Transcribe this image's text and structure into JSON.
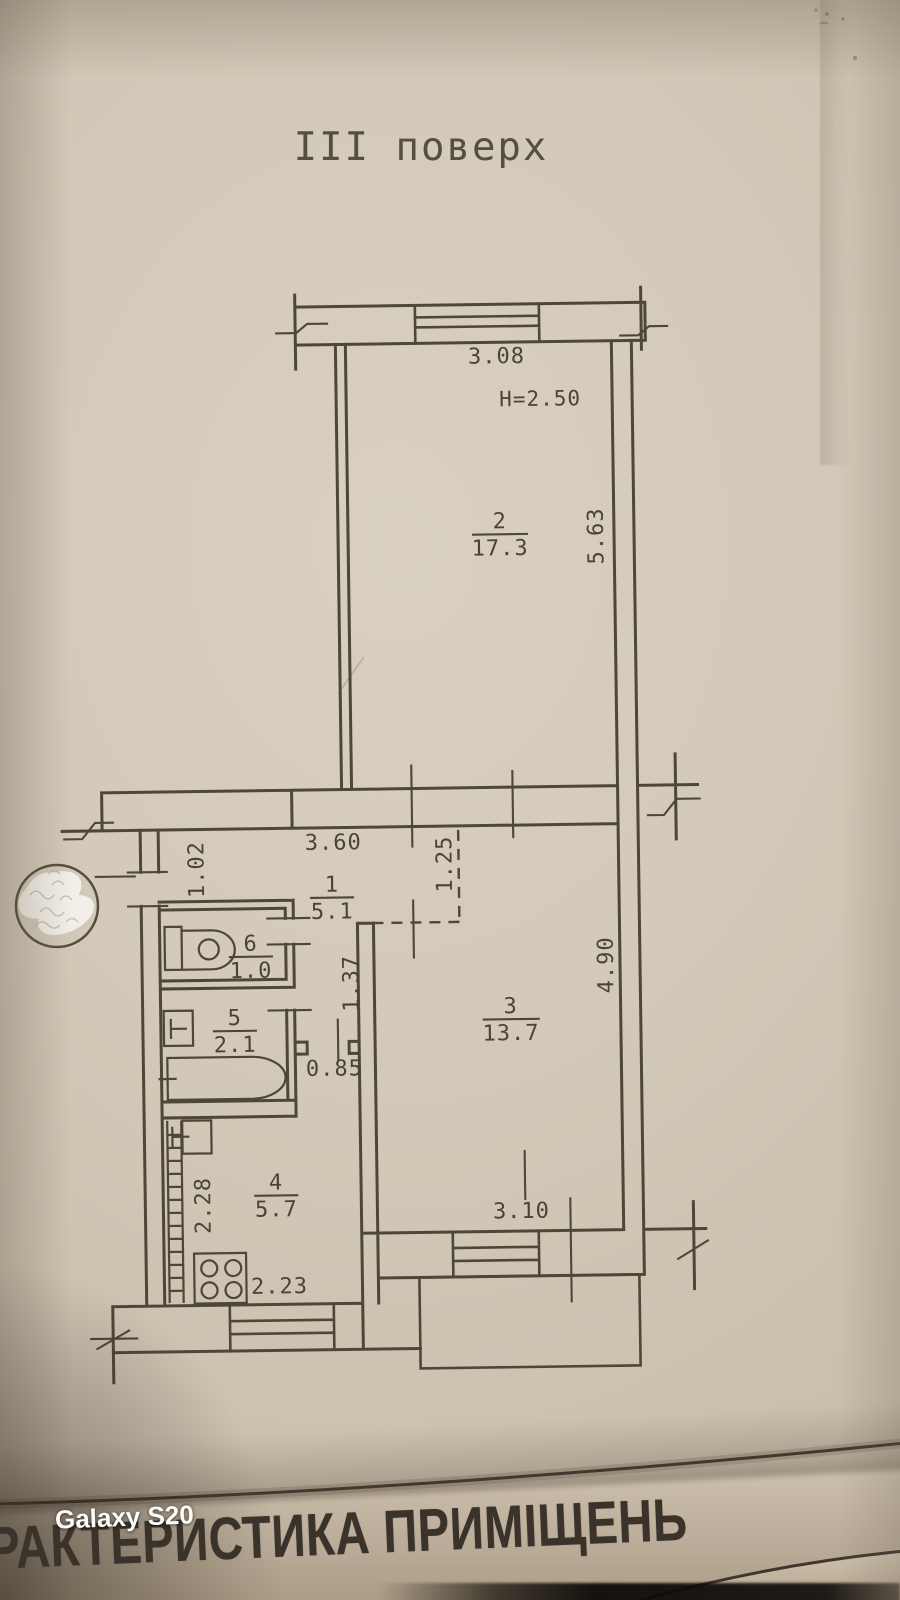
{
  "page": {
    "floor_title": "III поверх",
    "bottom_heading": "РАКТЕРИСТИКА ПРИМІЩЕНЬ",
    "camera_watermark": "Galaxy S20"
  },
  "plan": {
    "height_note": "H=2.50",
    "rooms": {
      "r1": {
        "number": "1",
        "area": "5.1"
      },
      "r2": {
        "number": "2",
        "area": "17.3"
      },
      "r3": {
        "number": "3",
        "area": "13.7"
      },
      "r4": {
        "number": "4",
        "area": "5.7"
      },
      "r5": {
        "number": "5",
        "area": "2.1"
      },
      "r6": {
        "number": "6",
        "area": "1.0"
      }
    },
    "dims": {
      "room2_width": "3.08",
      "room2_depth": "5.63",
      "hall_width": "3.60",
      "entry_width": "1.02",
      "hall_opening": "1.25",
      "nook_depth": "1.37",
      "nook_door": "0.85",
      "room3_depth": "4.90",
      "room3_width": "3.10",
      "kitchen_depth": "2.28",
      "kitchen_width": "2.23"
    },
    "colors": {
      "ink": "#4d463a",
      "paper": "#d2c8b7"
    }
  }
}
